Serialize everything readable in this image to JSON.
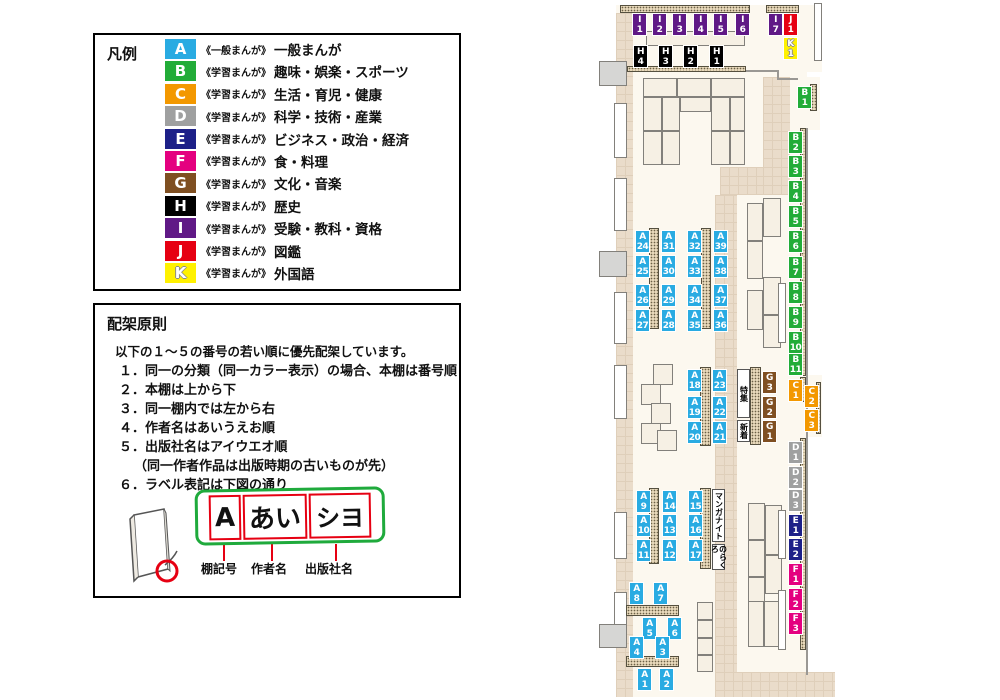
{
  "colors": {
    "legend_border": "#000000",
    "frame_green": "#1faa3c",
    "label_red": "#e60012",
    "floor": "#fcf8ef",
    "corridor": "#eadcca"
  },
  "legend": {
    "title": "凡例",
    "items": [
      {
        "code": "A",
        "color": "#29abe2",
        "type": "《一般まんが》",
        "category": "一般まんが"
      },
      {
        "code": "B",
        "color": "#22ac38",
        "type": "《学習まんが》",
        "category": "趣味・娯楽・スポーツ"
      },
      {
        "code": "C",
        "color": "#f39800",
        "type": "《学習まんが》",
        "category": "生活・育児・健康"
      },
      {
        "code": "D",
        "color": "#9fa0a0",
        "type": "《学習まんが》",
        "category": "科学・技術・産業"
      },
      {
        "code": "E",
        "color": "#1d2088",
        "type": "《学習まんが》",
        "category": "ビジネス・政治・経済"
      },
      {
        "code": "F",
        "color": "#e4007f",
        "type": "《学習まんが》",
        "category": "食・料理"
      },
      {
        "code": "G",
        "color": "#7f4f21",
        "type": "《学習まんが》",
        "category": "文化・音楽"
      },
      {
        "code": "H",
        "color": "#000000",
        "type": "《学習まんが》",
        "category": "歴史"
      },
      {
        "code": "I",
        "color": "#601986",
        "type": "《学習まんが》",
        "category": "受験・教科・資格"
      },
      {
        "code": "J",
        "color": "#e60012",
        "type": "《学習まんが》",
        "category": "図鑑"
      },
      {
        "code": "K",
        "color": "#fff100",
        "type": "《学習まんが》",
        "category": "外国語",
        "outline": true
      }
    ]
  },
  "principles": {
    "title": "配架原則",
    "intro": "以下の１～５の番号の若い順に優先配架しています。",
    "rules": [
      "１．同一の分類（同一カラー表示）の場合、本棚は番号順",
      "２．本棚は上から下",
      "３．同一棚内では左から右",
      "４．作者名はあいうえお順",
      "５．出版社名はアイウエオ順",
      "（同一作者作品は出版時期の古いものが先）",
      "６．ラベル表記は下図の通り"
    ],
    "label_example": {
      "shelf_code": "A",
      "author": "あい",
      "publisher": "シヨ",
      "captions": [
        "棚記号",
        "作者名",
        "出版社名"
      ]
    }
  },
  "map": {
    "labels": [
      {
        "t": "I",
        "n": "1",
        "x": 632,
        "y": 13
      },
      {
        "t": "I",
        "n": "2",
        "x": 652,
        "y": 13
      },
      {
        "t": "I",
        "n": "3",
        "x": 672,
        "y": 13
      },
      {
        "t": "I",
        "n": "4",
        "x": 693,
        "y": 13
      },
      {
        "t": "I",
        "n": "5",
        "x": 713,
        "y": 13
      },
      {
        "t": "I",
        "n": "6",
        "x": 735,
        "y": 13
      },
      {
        "t": "I",
        "n": "7",
        "x": 768,
        "y": 13
      },
      {
        "t": "J",
        "n": "1",
        "x": 783,
        "y": 13
      },
      {
        "t": "K",
        "n": "1",
        "x": 783,
        "y": 37
      },
      {
        "t": "H",
        "n": "4",
        "x": 633,
        "y": 45
      },
      {
        "t": "H",
        "n": "3",
        "x": 658,
        "y": 45
      },
      {
        "t": "H",
        "n": "2",
        "x": 683,
        "y": 45
      },
      {
        "t": "H",
        "n": "1",
        "x": 709,
        "y": 45
      },
      {
        "t": "B",
        "n": "1",
        "x": 797,
        "y": 86
      },
      {
        "t": "B",
        "n": "2",
        "x": 788,
        "y": 131
      },
      {
        "t": "B",
        "n": "3",
        "x": 788,
        "y": 155
      },
      {
        "t": "B",
        "n": "4",
        "x": 788,
        "y": 180
      },
      {
        "t": "B",
        "n": "5",
        "x": 788,
        "y": 205
      },
      {
        "t": "B",
        "n": "6",
        "x": 788,
        "y": 230
      },
      {
        "t": "B",
        "n": "7",
        "x": 788,
        "y": 256
      },
      {
        "t": "B",
        "n": "8",
        "x": 788,
        "y": 281
      },
      {
        "t": "B",
        "n": "9",
        "x": 788,
        "y": 306
      },
      {
        "t": "B",
        "n": "10",
        "x": 788,
        "y": 331
      },
      {
        "t": "B",
        "n": "11",
        "x": 788,
        "y": 353
      },
      {
        "t": "C",
        "n": "1",
        "x": 788,
        "y": 379
      },
      {
        "t": "C",
        "n": "2",
        "x": 804,
        "y": 385
      },
      {
        "t": "C",
        "n": "3",
        "x": 804,
        "y": 409
      },
      {
        "t": "D",
        "n": "1",
        "x": 788,
        "y": 441
      },
      {
        "t": "D",
        "n": "2",
        "x": 788,
        "y": 466
      },
      {
        "t": "D",
        "n": "3",
        "x": 788,
        "y": 489
      },
      {
        "t": "E",
        "n": "1",
        "x": 788,
        "y": 514
      },
      {
        "t": "E",
        "n": "2",
        "x": 788,
        "y": 538
      },
      {
        "t": "F",
        "n": "1",
        "x": 788,
        "y": 563
      },
      {
        "t": "F",
        "n": "2",
        "x": 788,
        "y": 588
      },
      {
        "t": "F",
        "n": "3",
        "x": 788,
        "y": 612
      },
      {
        "t": "G",
        "n": "3",
        "x": 762,
        "y": 371
      },
      {
        "t": "G",
        "n": "2",
        "x": 762,
        "y": 396
      },
      {
        "t": "G",
        "n": "1",
        "x": 762,
        "y": 420
      },
      {
        "t": "A",
        "n": "24",
        "x": 635,
        "y": 230
      },
      {
        "t": "A",
        "n": "25",
        "x": 635,
        "y": 255
      },
      {
        "t": "A",
        "n": "26",
        "x": 635,
        "y": 284
      },
      {
        "t": "A",
        "n": "27",
        "x": 635,
        "y": 309
      },
      {
        "t": "A",
        "n": "31",
        "x": 661,
        "y": 230
      },
      {
        "t": "A",
        "n": "30",
        "x": 661,
        "y": 255
      },
      {
        "t": "A",
        "n": "29",
        "x": 661,
        "y": 284
      },
      {
        "t": "A",
        "n": "28",
        "x": 661,
        "y": 309
      },
      {
        "t": "A",
        "n": "32",
        "x": 687,
        "y": 230
      },
      {
        "t": "A",
        "n": "33",
        "x": 687,
        "y": 255
      },
      {
        "t": "A",
        "n": "34",
        "x": 687,
        "y": 284
      },
      {
        "t": "A",
        "n": "35",
        "x": 687,
        "y": 309
      },
      {
        "t": "A",
        "n": "39",
        "x": 713,
        "y": 230
      },
      {
        "t": "A",
        "n": "38",
        "x": 713,
        "y": 255
      },
      {
        "t": "A",
        "n": "37",
        "x": 713,
        "y": 284
      },
      {
        "t": "A",
        "n": "36",
        "x": 713,
        "y": 309
      },
      {
        "t": "A",
        "n": "18",
        "x": 687,
        "y": 369
      },
      {
        "t": "A",
        "n": "19",
        "x": 687,
        "y": 396
      },
      {
        "t": "A",
        "n": "20",
        "x": 687,
        "y": 421
      },
      {
        "t": "A",
        "n": "23",
        "x": 712,
        "y": 369
      },
      {
        "t": "A",
        "n": "22",
        "x": 712,
        "y": 396
      },
      {
        "t": "A",
        "n": "21",
        "x": 712,
        "y": 421
      },
      {
        "t": "A",
        "n": "9",
        "x": 636,
        "y": 490
      },
      {
        "t": "A",
        "n": "10",
        "x": 636,
        "y": 514
      },
      {
        "t": "A",
        "n": "11",
        "x": 636,
        "y": 539
      },
      {
        "t": "A",
        "n": "14",
        "x": 662,
        "y": 490
      },
      {
        "t": "A",
        "n": "13",
        "x": 662,
        "y": 514
      },
      {
        "t": "A",
        "n": "12",
        "x": 662,
        "y": 539
      },
      {
        "t": "A",
        "n": "15",
        "x": 688,
        "y": 490
      },
      {
        "t": "A",
        "n": "16",
        "x": 688,
        "y": 514
      },
      {
        "t": "A",
        "n": "17",
        "x": 688,
        "y": 539
      },
      {
        "t": "A",
        "n": "8",
        "x": 629,
        "y": 582
      },
      {
        "t": "A",
        "n": "7",
        "x": 653,
        "y": 582
      },
      {
        "t": "A",
        "n": "5",
        "x": 642,
        "y": 617
      },
      {
        "t": "A",
        "n": "6",
        "x": 667,
        "y": 617
      },
      {
        "t": "A",
        "n": "4",
        "x": 629,
        "y": 636
      },
      {
        "t": "A",
        "n": "3",
        "x": 655,
        "y": 636
      },
      {
        "t": "A",
        "n": "1",
        "x": 637,
        "y": 668
      },
      {
        "t": "A",
        "n": "2",
        "x": 659,
        "y": 668
      }
    ],
    "specials": [
      {
        "text": "特集",
        "x": 737,
        "y": 369,
        "w": 13,
        "h": 49
      },
      {
        "text": "新着",
        "x": 737,
        "y": 420,
        "w": 13,
        "h": 22
      },
      {
        "text": "マンガナイト",
        "x": 712,
        "y": 489,
        "w": 13,
        "h": 53
      },
      {
        "text": "のらくろ",
        "x": 712,
        "y": 544,
        "w": 13,
        "h": 26
      }
    ]
  }
}
